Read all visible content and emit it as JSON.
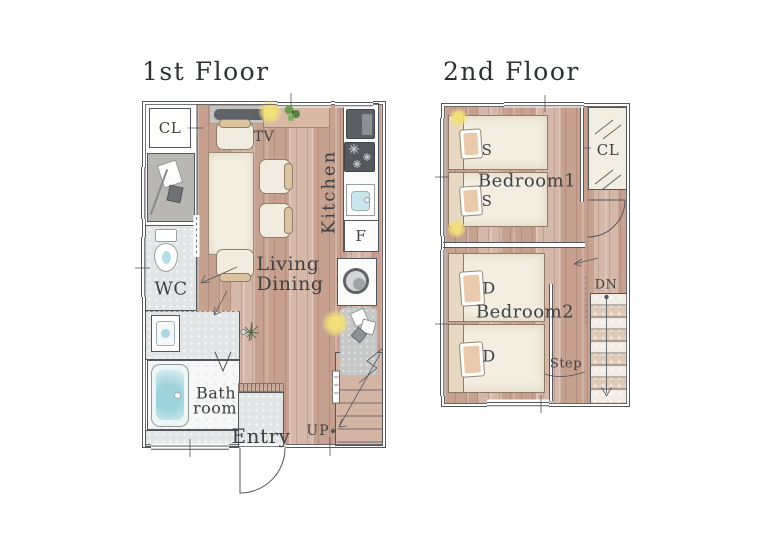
{
  "colors": {
    "wall": "#53565a",
    "label": "#3e4044",
    "wood": "#cdab9c",
    "tile": "#e1e5e6",
    "water": "#abd8e2",
    "light": "#f3e07a",
    "plant": "#6f9e52",
    "appliance": "#5c6064",
    "bed": "#f3eee1",
    "pillow": "#ebc9ab",
    "rug": "#c6c7c7",
    "closet": "#b8b7b3",
    "shelf": "#d9b9a3",
    "stair": "#ecdfd1"
  },
  "floor1": {
    "title": "1st Floor",
    "labels": {
      "cl": "CL",
      "tv": "TV",
      "kitchen": "Kitchen",
      "fridge": "F",
      "wc": "WC",
      "living": "Living",
      "dining": "Dining",
      "bath_line1": "Bath",
      "bath_line2": "room",
      "entry": "Entry",
      "up": "UP"
    }
  },
  "floor2": {
    "title": "2nd Floor",
    "labels": {
      "bed_s1": "S",
      "bed_s2": "S",
      "bedroom1": "Bedroom1",
      "cl": "CL",
      "bed_d1": "D",
      "bed_d2": "D",
      "bedroom2": "Bedroom2",
      "step": "Step",
      "dn": "DN"
    }
  }
}
